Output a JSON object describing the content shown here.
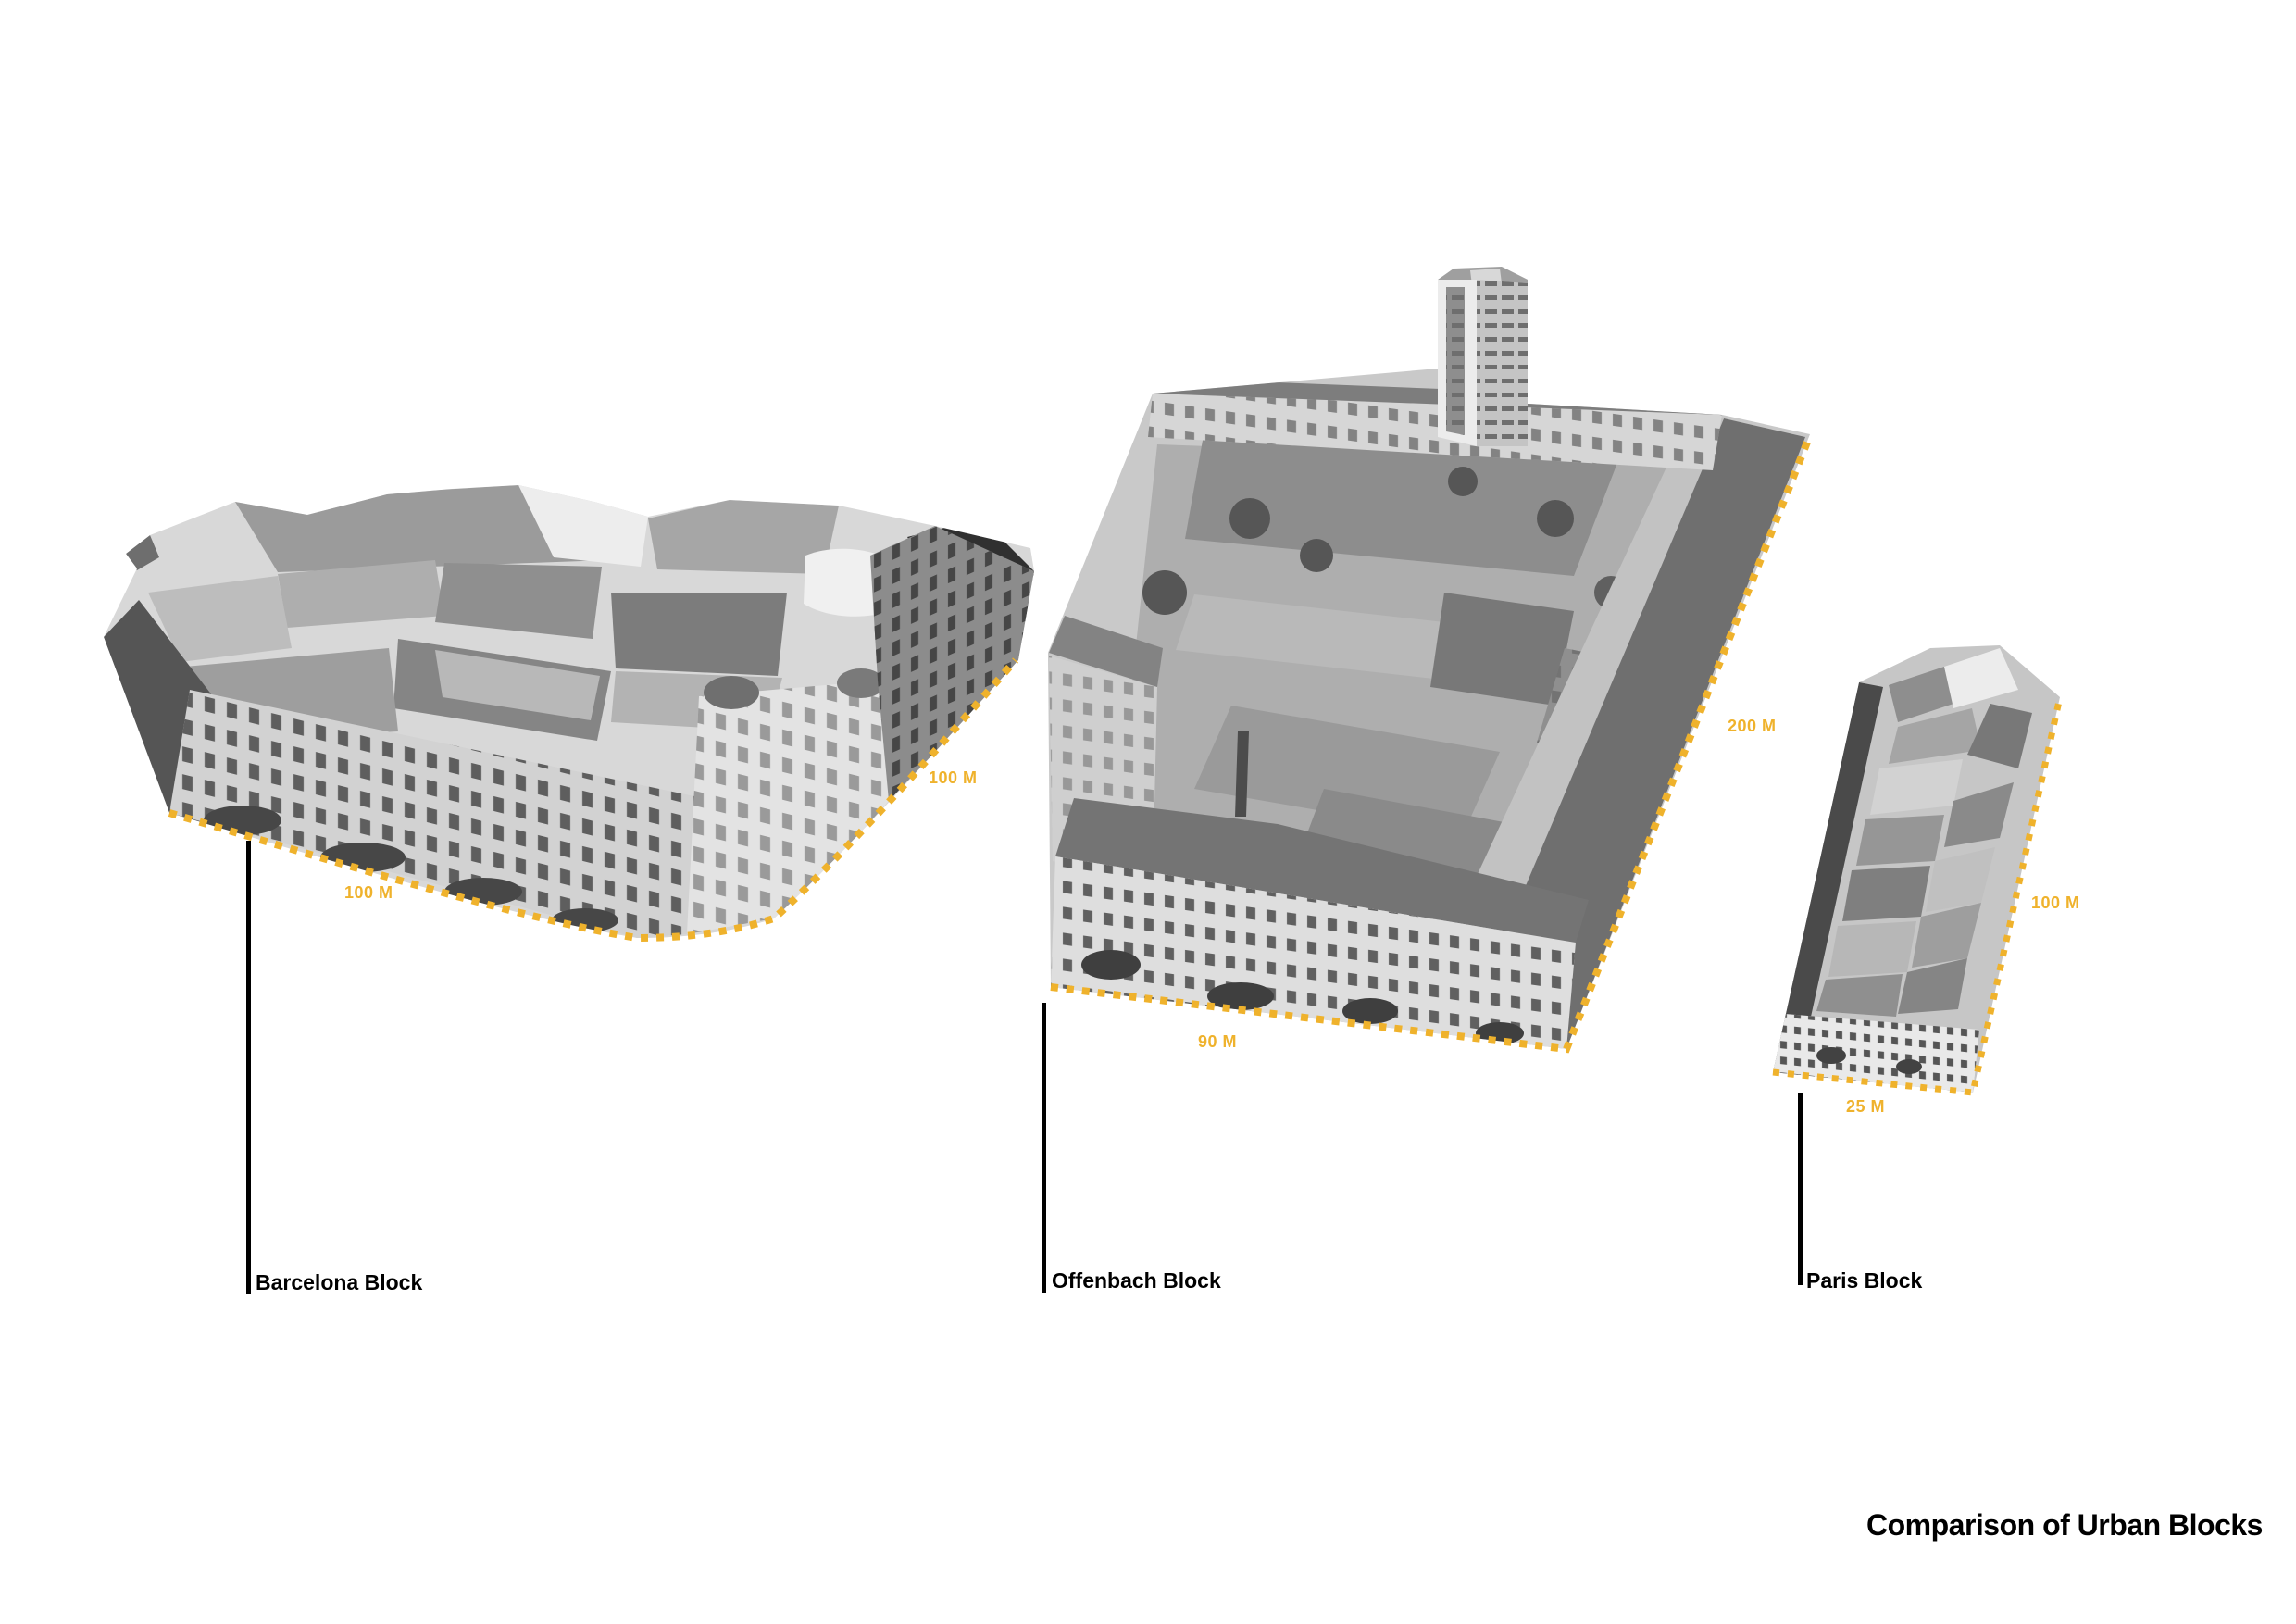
{
  "title": "Comparison of Urban Blocks",
  "colors": {
    "accent": "#EFB22C",
    "ink": "#000000"
  },
  "blocks": [
    {
      "name": "Barcelona Block",
      "bottom_dim": "100 M",
      "side_dim": "100 M"
    },
    {
      "name": "Offenbach Block",
      "bottom_dim": "90 M",
      "side_dim": "200 M"
    },
    {
      "name": "Paris Block",
      "bottom_dim": "25 M",
      "side_dim": "100 M"
    }
  ]
}
